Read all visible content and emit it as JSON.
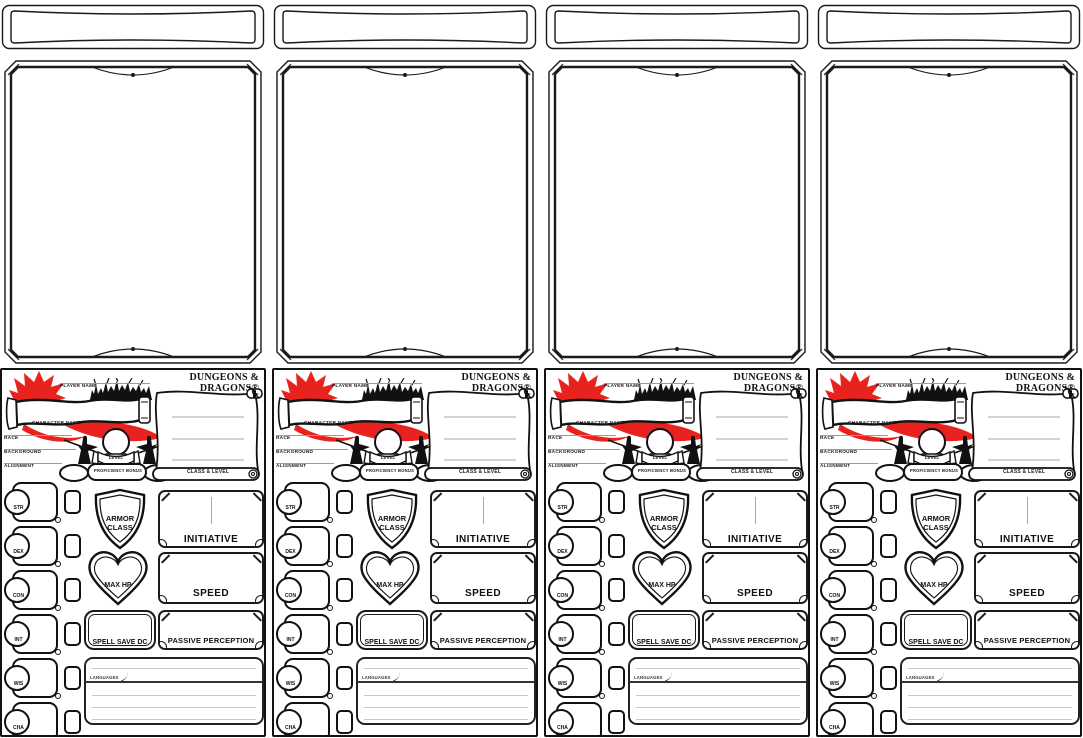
{
  "card_count": 4,
  "colors": {
    "ink": "#1a1a1a",
    "red": "#e8231f",
    "line_gray": "#9a9a9a",
    "light_line": "#c9c9c9"
  },
  "card": {
    "logo": "DUNGEONS & DRAGONS®",
    "header": {
      "player_name_label": "PLAYER NAME",
      "character_name_label": "CHARACTER NAME",
      "race_label": "RACE",
      "background_label": "BACKGROUND",
      "alignment_label": "ALIGNMENT",
      "level_label": "LEVEL",
      "proficiency_label": "PROFICIENCY BONUS",
      "class_level_label": "CLASS & LEVEL"
    },
    "abilities": [
      "STR",
      "DEX",
      "CON",
      "INT",
      "WIS",
      "CHA"
    ],
    "stats": {
      "armor_class": "ARMOR CLASS",
      "initiative": "INITIATIVE",
      "max_hp": "MAX HP",
      "speed": "SPEED",
      "spell_save_dc": "SPELL SAVE DC",
      "passive_perception": "PASSIVE PERCEPTION"
    },
    "languages_label": "LANGUAGES"
  }
}
